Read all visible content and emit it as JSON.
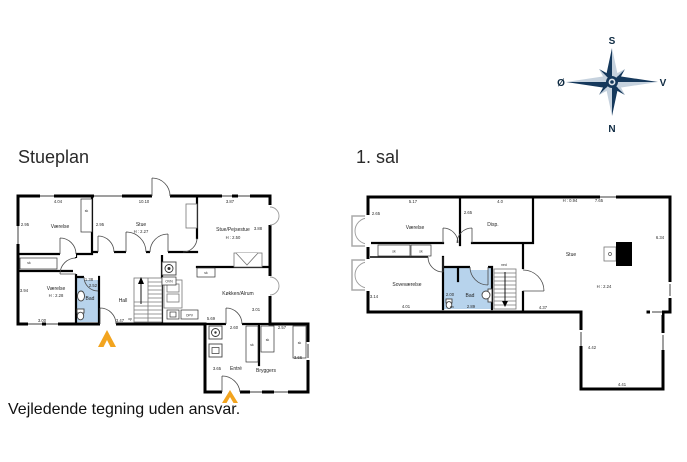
{
  "page": {
    "ground_title": "Stueplan",
    "first_title": "1. sal",
    "disclaimer": "Vejledende tegning uden ansvar."
  },
  "compass": {
    "north": "N",
    "south": "S",
    "east": "Ø",
    "west": "V"
  },
  "colors": {
    "wall": "#000000",
    "bath": "#b7d3ec",
    "arrow": "#f2a41f",
    "navy": "#16395c",
    "navylight": "#c6d2de",
    "window": "#9f9f9f"
  },
  "shared": {
    "closet": "sk",
    "stairs_up": "op",
    "stairs_down": "ned",
    "oven": "OVN",
    "dishwasher": "OPV",
    "wc": "wc"
  },
  "stueplan": {
    "rooms": {
      "vaerelse1": "Værelse",
      "stue": "Stue",
      "stue_h": "H : 2.27",
      "pejsestue": "Stue/Pejsestue",
      "pejsestue_h": "H : 2.50",
      "vaerelse2": "Værelse",
      "vaerelse2_h": "H : 2.28",
      "bad": "Bad",
      "hall": "Hall",
      "koekken": "Køkken/Alrum",
      "entre": "Entré",
      "bryggers": "Bryggers"
    },
    "dims": {
      "v1_w": "4.04",
      "v1_d": "2.95",
      "stue_d": "2.95",
      "stue_w": "10.10",
      "pej_w": "3.87",
      "pej_d": "3.88",
      "v2_d": "3.94",
      "v2_w": "3.00",
      "bad_w": "1.38",
      "bad_d": "2.52",
      "hall_w": "3.47",
      "kok_d": "3.01",
      "kok_w": "5.69",
      "entre_top": "2.60",
      "bryg_top": "2.57",
      "bryg_d": "3.66",
      "entre_d": "3.65"
    }
  },
  "firstsal": {
    "rooms": {
      "vaerelse": "Værelse",
      "disp": "Disp.",
      "sovevaerelse": "Soveværelse",
      "bad": "Bad",
      "stue": "Stue",
      "stue_h": "H : 2.24",
      "stue_h_low": "H : 0.94"
    },
    "dims": {
      "v_w": "5.17",
      "v_d": "2.65",
      "disp_w": "4.0",
      "disp_d": "2.65",
      "stue_w": "7.65",
      "stue_d": "6.34",
      "sove_d": "3.14",
      "sove_w": "4.01",
      "bad_w": "2.00",
      "bad_w2": "2.89",
      "stue_b": "4.37",
      "ext_d": "4.42",
      "ext_w": "4.41"
    }
  }
}
